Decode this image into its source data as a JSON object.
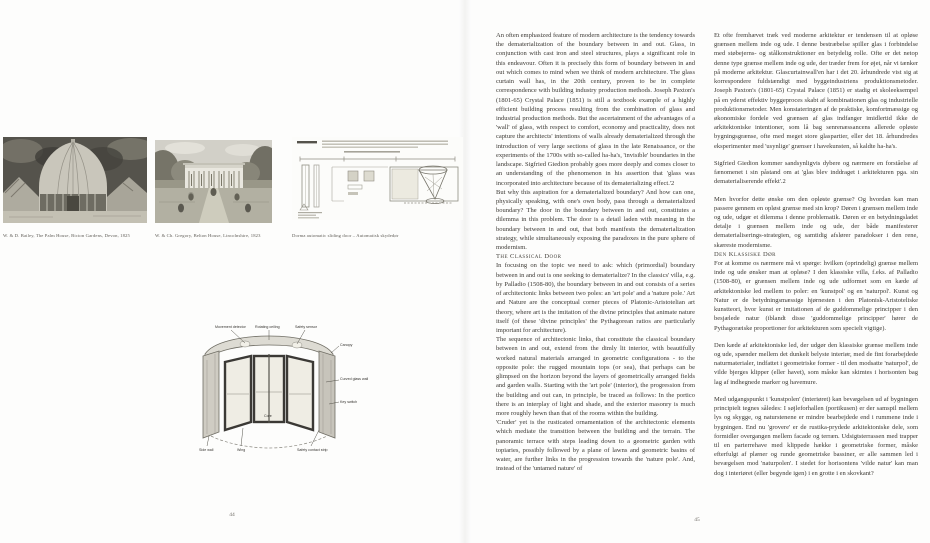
{
  "left_page": {
    "figures": [
      {
        "caption": "W. & D. Bailey, The Palm House, Bicton Gardens, Devon, 1825"
      },
      {
        "caption": "W. & Ch. Gregory, Belton House, Lincolnshire, 1823"
      },
      {
        "caption": "Dorma automatic sliding door – Automatisk skydedør"
      }
    ],
    "diagram": {
      "movement_detector": "Movement detector",
      "rotating_ceiling": "Rotating ceiling",
      "safety_sensor": "Safety sensor",
      "canopy": "Canopy",
      "glass_wall": "Curved glass wall",
      "key_switch": "Key switch",
      "safety_strip": "Safety contact strip",
      "side_wall": "Side wall",
      "wing": "Wing",
      "core": "Core"
    },
    "page_number": "44"
  },
  "right_page": {
    "english": {
      "p1": "An often emphasized feature of modern architecture is the tendency towards the dematerialization of the boundary between in and out. Glass, in conjunction with cast iron and steel structures, plays a significant role in this endeavour. Often it is precisely this form of boundary between in and out which comes to mind when we think of modern architecture. The glass curtain wall has, in the 20th century, proven to be in complete correspondence with building industry production methods. Joseph Paxton's (1801-65) Crystal Palace (1851) is still a textbook example of a highly efficient building process resulting from the combination of glass and industrial production methods. But the ascertainment of the advantages of a 'wall' of glass, with respect to comfort, economy and practicality, does not capture the architects' intentions of walls already dematerialized through the introduction of very large sections of glass in the late Renaissance, or the experiments of the 1700s with so-called ha-ha's, 'invisible' boundaries in the landscape. Sigfried Giedion probably goes more deeply and comes closer to an understanding of the phenomenon in his assertion that 'glass was incorporated into architecture because of its dematerializing effect.'2",
      "p2": "But why this aspiration for a dematerialized boundary? And how can one, physically speaking, with one's own body, pass through a dematerialized boundary? The door in the boundary between in and out, constitutes a dilemma in this problem. The door is a detail laden with meaning in the boundary between in and out, that both manifests the dematerialization strategy, while simultaneously exposing the paradoxes in the pure sphere of modernism.",
      "heading": "The Classical Door",
      "p3": "In focusing on the topic we need to ask: which (primordial) boundary between in and out is one seeking to dematerialize? In the classics' villa, e.g. by Palladio (1508-80), the boundary between in and out consists of a series of architectonic links between two poles: an 'art pole' and a 'nature pole.' Art and Nature are the conceptual corner pieces of Platonic-Aristotelian art theory, where art is the imitation of the divine principles that animate nature itself (of these 'divine principles' the Pythagorean ratios are particularly important for architecture).",
      "p4": "The sequence of architectonic links, that constitute the classical boundary between in and out, extend from the dimly lit interior, with beautifully worked natural materials arranged in geometric configurations - to the opposite pole: the rugged mountain tops (or sea), that perhaps can be glimpsed on the horizon beyond the layers of geometrically arranged fields and garden walls. Starting with the 'art pole' (interior), the progression from the building and out can, in principle, be traced as follows: In the portico there is an interplay of light and shade, and the exterior masonry is much more roughly hewn than that of the rooms within the building.",
      "p5": "'Cruder' yet is the rusticated ornamentation of the architectonic elements which mediate the transition between the building and the terrain. The panoramic terrace with steps leading down to a geometric garden with topiaries, possibly followed by a plane of lawns and geometric basins of water, are further links in the progression towards the 'nature pole'. And, instead of the 'untamed nature' of"
    },
    "danish": {
      "p1": "Et ofte fremhævet træk ved moderne arkitektur er tendensen til at opløse grænsen mellem inde og ude. I denne bestræbelse spiller glas i forbindelse med støbejerns- og stålkonstruktioner en betydelig rolle. Ofte er det netop denne type grænse mellem inde og ude, der træder frem for øjet, når vi tænker på moderne arkitektur. Glascurtainwall'en har i det 20. århundrede vist sig at korrespondere fuldstændigt med byggeindustriens produktionsmetoder. Joseph Paxton's (1801-65) Crystal Palace (1851) er stadig et skoleeksempel på en yderst effektiv byggeproces skabt af kombinationen glas og industrielle produktionsmetoder. Men konstateringen af de praktiske, komfortmæssige og økonomiske fordele ved grænsen af glas indfanger imidlertid ikke de arkitektoniske intentioner, som lå bag senrenæssancens allerede opløste bygningsgrænse, ofte med meget store glaspartier, eller det 18. århundredes eksperimenter med 'usynlige' grænser i havekunsten, så kaldte ha-ha's.",
      "p2": "Sigfried Giedion kommer sandsynligvis dybere og nærmere en forståelse af fænomenet i sin påstand om at 'glas blev inddraget i arkitekturen pga. sin dematerialiserende effekt'.2",
      "p3": "Men hvorfor dette ønske om den opløste grænse? Og hvordan kan man passere gennem en opløst grænse med sin krop? Døren i grænsen mellem inde og ude, udgør et dilemma i denne problematik. Døren er en betydningsladet detalje i grænsen mellem inde og ude, der både manifesterer dematerialiserings-strategien, og samtidig afslører paradokser i den rene, skæreste modernisme.",
      "heading": "Den Klassiske Dør",
      "p4": "For at komme os nærmere må vi spørge: hvilken (oprindelig) grænse mellem inde og ude ønsker man at opløse? I den klassiske villa, f.eks. af Palladio (1508-80), er grænsen mellem inde og ude udformet som en kæde af arkitektoniske led mellem to poler: en 'kunstpol' og en 'naturpol'. Kunst og Natur er de betydningsmæssige hjørnesten i den Platonisk-Aristoteliske kunstteori, hvor kunst er imitationen af de guddommelige principper i den besjælede natur (iblandt disse 'guddommelige principper' hører de Pythagoræiske proportioner for arkitekturen som specielt vigtige).",
      "p5": "Den kæde af arkitektoniske led, der udgør den klassiske grænse mellem inde og ude, spænder mellem det dunkelt belyste interiør, med de fint forarbejdede naturmaterialer, indfattet i geometriske former - til den modsatte 'naturpol', de vilde bjerges klipper (eller havet), som måske kan skimtes i horisonten bag lag af indhegnede marker og havemure.",
      "p6": "Med udgangspunkt i 'kunstpolen' (interiøret) kan bevægelsen ud af bygningen principielt tegnes således: I søjleforhallen (portikusen) er der samspil mellem lys og skygge, og naturstenene er mindre bearbejdede end i rummene inde i bygningen. End nu 'grovere' er de rustika-prydede arkitektoniske dele, som formidler overgangen mellem facade og terræn. Udsigtsterrassen med trapper til en parterrehave med klippede hække i geometriske former, måske efterfulgt af plæner og runde geometriske bassiner, er alle sammen led i bevægelsen mod 'naturpolen'. I stedet for horisontens 'vilde natur' kan man dog i interiøret (eller begynde igen) i en grotte i en skovkant?"
    },
    "page_number": "45"
  }
}
